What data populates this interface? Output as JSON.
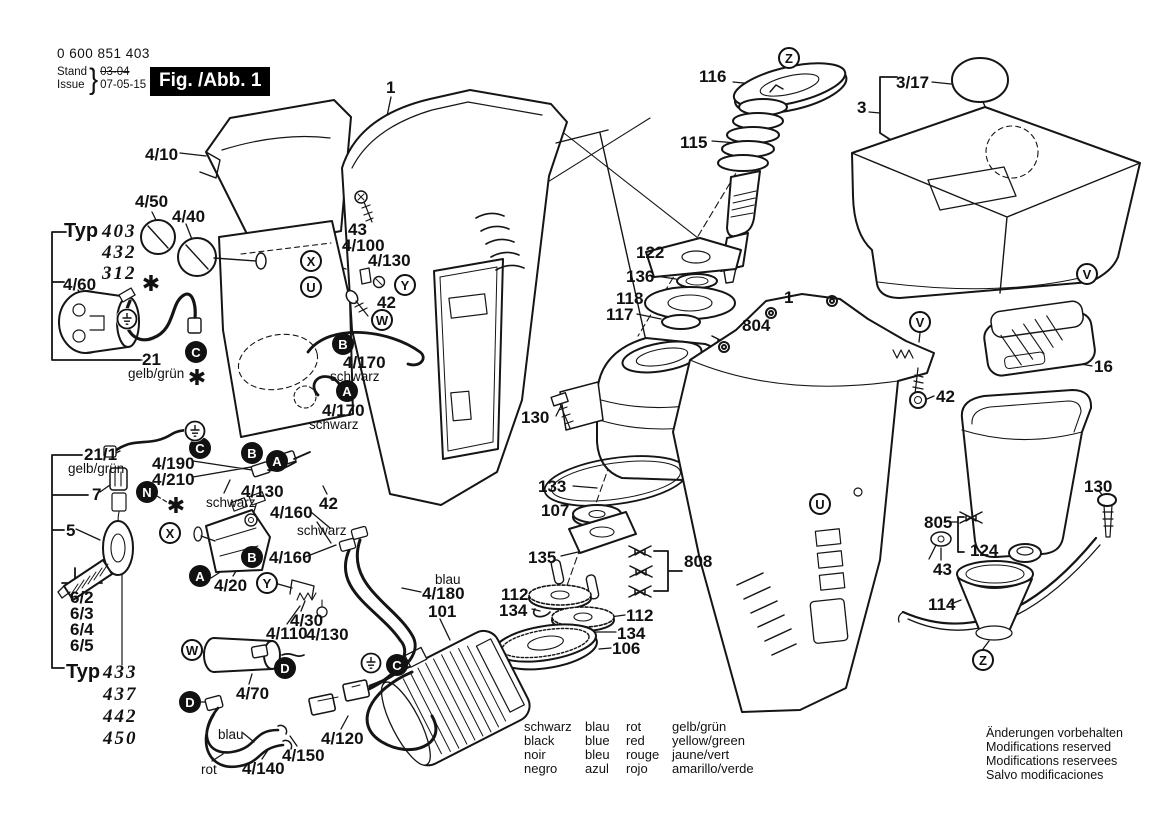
{
  "header": {
    "part_number": "0 600 851 403",
    "stand_label": "Stand",
    "issue_label": "Issue",
    "superseded_date": "03-04",
    "issue_date": "07-05-15",
    "figure_label": "Fig. /Abb. 1"
  },
  "typ_groups": [
    {
      "label": "Typ",
      "x": 64,
      "y": 220,
      "vx": 102,
      "vy": 221,
      "dy": 21,
      "values": [
        "403",
        "432",
        "312"
      ]
    },
    {
      "label": "Typ",
      "x": 66,
      "y": 661,
      "vx": 103,
      "vy": 662,
      "dy": 22,
      "values": [
        "433",
        "437",
        "442",
        "450"
      ]
    }
  ],
  "callouts": [
    {
      "t": "4/10",
      "x": 145,
      "y": 146
    },
    {
      "t": "4/50",
      "x": 135,
      "y": 193
    },
    {
      "t": "4/40",
      "x": 172,
      "y": 208
    },
    {
      "t": "4/60",
      "x": 63,
      "y": 276
    },
    {
      "t": "21",
      "x": 142,
      "y": 351
    },
    {
      "t": "gelb/grün",
      "x": 128,
      "y": 366,
      "cls": "color"
    },
    {
      "t": "21/1",
      "x": 84,
      "y": 446
    },
    {
      "t": "gelb/grün",
      "x": 68,
      "y": 461,
      "cls": "color"
    },
    {
      "t": "7",
      "x": 92,
      "y": 486
    },
    {
      "t": "5",
      "x": 66,
      "y": 522
    },
    {
      "t": "6/2",
      "x": 70,
      "y": 589
    },
    {
      "t": "6/3",
      "x": 70,
      "y": 605
    },
    {
      "t": "6/4",
      "x": 70,
      "y": 621
    },
    {
      "t": "6/5",
      "x": 70,
      "y": 637
    },
    {
      "t": "4/190",
      "x": 152,
      "y": 455
    },
    {
      "t": "4/210",
      "x": 152,
      "y": 471
    },
    {
      "t": "schwarz",
      "x": 206,
      "y": 495,
      "cls": "color"
    },
    {
      "t": "4/130",
      "x": 241,
      "y": 483
    },
    {
      "t": "4/160",
      "x": 270,
      "y": 504
    },
    {
      "t": "schwarz",
      "x": 297,
      "y": 523,
      "cls": "color"
    },
    {
      "t": "4/160",
      "x": 269,
      "y": 549
    },
    {
      "t": "4/20",
      "x": 214,
      "y": 577
    },
    {
      "t": "4/30",
      "x": 290,
      "y": 612
    },
    {
      "t": "4/110",
      "x": 266,
      "y": 625
    },
    {
      "t": "4/130",
      "x": 306,
      "y": 626
    },
    {
      "t": "4/70",
      "x": 236,
      "y": 685
    },
    {
      "t": "blau",
      "x": 218,
      "y": 727,
      "cls": "color"
    },
    {
      "t": "4/120",
      "x": 321,
      "y": 730
    },
    {
      "t": "4/150",
      "x": 282,
      "y": 747
    },
    {
      "t": "rot",
      "x": 201,
      "y": 762,
      "cls": "color"
    },
    {
      "t": "4/140",
      "x": 242,
      "y": 760
    },
    {
      "t": "1",
      "x": 386,
      "y": 79
    },
    {
      "t": "43",
      "x": 348,
      "y": 221
    },
    {
      "t": "4/100",
      "x": 342,
      "y": 237
    },
    {
      "t": "4/130",
      "x": 368,
      "y": 252
    },
    {
      "t": "42",
      "x": 377,
      "y": 294
    },
    {
      "t": "4/170",
      "x": 343,
      "y": 354
    },
    {
      "t": "schwarz",
      "x": 330,
      "y": 369,
      "cls": "color"
    },
    {
      "t": "4/170",
      "x": 322,
      "y": 402
    },
    {
      "t": "schwarz",
      "x": 309,
      "y": 417,
      "cls": "color"
    },
    {
      "t": "42",
      "x": 319,
      "y": 495
    },
    {
      "t": "blau",
      "x": 435,
      "y": 572,
      "cls": "color"
    },
    {
      "t": "4/180",
      "x": 422,
      "y": 585
    },
    {
      "t": "101",
      "x": 428,
      "y": 603
    },
    {
      "t": "116",
      "x": 699,
      "y": 68
    },
    {
      "t": "115",
      "x": 680,
      "y": 134
    },
    {
      "t": "122",
      "x": 636,
      "y": 244
    },
    {
      "t": "136",
      "x": 626,
      "y": 268
    },
    {
      "t": "118",
      "x": 616,
      "y": 290
    },
    {
      "t": "117",
      "x": 606,
      "y": 306
    },
    {
      "t": "804",
      "x": 742,
      "y": 317
    },
    {
      "t": "1",
      "x": 784,
      "y": 289
    },
    {
      "t": "130",
      "x": 521,
      "y": 409
    },
    {
      "t": "133",
      "x": 538,
      "y": 478
    },
    {
      "t": "107",
      "x": 541,
      "y": 502
    },
    {
      "t": "135",
      "x": 528,
      "y": 549
    },
    {
      "t": "808",
      "x": 684,
      "y": 553
    },
    {
      "t": "112",
      "x": 501,
      "y": 586
    },
    {
      "t": "134",
      "x": 499,
      "y": 602
    },
    {
      "t": "112",
      "x": 626,
      "y": 607
    },
    {
      "t": "134",
      "x": 617,
      "y": 625
    },
    {
      "t": "106",
      "x": 612,
      "y": 640
    },
    {
      "t": "3/17",
      "x": 896,
      "y": 74
    },
    {
      "t": "3",
      "x": 857,
      "y": 99
    },
    {
      "t": "42",
      "x": 936,
      "y": 388
    },
    {
      "t": "16",
      "x": 1094,
      "y": 358
    },
    {
      "t": "130",
      "x": 1084,
      "y": 478
    },
    {
      "t": "805",
      "x": 924,
      "y": 514
    },
    {
      "t": "124",
      "x": 970,
      "y": 542
    },
    {
      "t": "43",
      "x": 933,
      "y": 561
    },
    {
      "t": "114",
      "x": 928,
      "y": 596
    }
  ],
  "markers": [
    {
      "l": "C",
      "x": 196,
      "y": 352,
      "f": true
    },
    {
      "l": "C",
      "x": 200,
      "y": 448,
      "f": true
    },
    {
      "l": "C",
      "x": 397,
      "y": 665,
      "f": true
    },
    {
      "l": "N",
      "x": 147,
      "y": 492,
      "f": true
    },
    {
      "l": "B",
      "x": 252,
      "y": 453,
      "f": true
    },
    {
      "l": "A",
      "x": 277,
      "y": 461,
      "f": true
    },
    {
      "l": "B",
      "x": 343,
      "y": 344,
      "f": true
    },
    {
      "l": "A",
      "x": 347,
      "y": 391,
      "f": true
    },
    {
      "l": "B",
      "x": 252,
      "y": 557,
      "f": true
    },
    {
      "l": "A",
      "x": 200,
      "y": 576,
      "f": true
    },
    {
      "l": "D",
      "x": 285,
      "y": 668,
      "f": true
    },
    {
      "l": "D",
      "x": 190,
      "y": 702,
      "f": true
    },
    {
      "l": "X",
      "x": 311,
      "y": 261,
      "f": false
    },
    {
      "l": "U",
      "x": 311,
      "y": 287,
      "f": false
    },
    {
      "l": "Y",
      "x": 405,
      "y": 285,
      "f": false
    },
    {
      "l": "W",
      "x": 382,
      "y": 320,
      "f": false
    },
    {
      "l": "X",
      "x": 170,
      "y": 533,
      "f": false
    },
    {
      "l": "Y",
      "x": 267,
      "y": 583,
      "f": false
    },
    {
      "l": "W",
      "x": 192,
      "y": 650,
      "f": false
    },
    {
      "l": "Z",
      "x": 789,
      "y": 58,
      "f": false
    },
    {
      "l": "V",
      "x": 1087,
      "y": 274,
      "f": false
    },
    {
      "l": "V",
      "x": 920,
      "y": 322,
      "f": false
    },
    {
      "l": "U",
      "x": 820,
      "y": 504,
      "f": false
    },
    {
      "l": "Z",
      "x": 983,
      "y": 660,
      "f": false
    }
  ],
  "symbols": {
    "asterisks": [
      [
        151,
        285
      ],
      [
        197,
        379
      ],
      [
        176,
        507
      ]
    ],
    "earth": [
      [
        127,
        319
      ],
      [
        195,
        431
      ],
      [
        371,
        663
      ]
    ]
  },
  "legend": {
    "rows": [
      [
        "schwarz",
        "blau",
        "rot",
        "gelb/grün"
      ],
      [
        "black",
        "blue",
        "red",
        "yellow/green"
      ],
      [
        "noir",
        "bleu",
        "rouge",
        "jaune/vert"
      ],
      [
        "negro",
        "azul",
        "rojo",
        "amarillo/verde"
      ]
    ]
  },
  "footer": {
    "lines": [
      "Änderungen vorbehalten",
      "Modifications reserved",
      "Modifications reservees",
      "Salvo modificaciones"
    ]
  }
}
